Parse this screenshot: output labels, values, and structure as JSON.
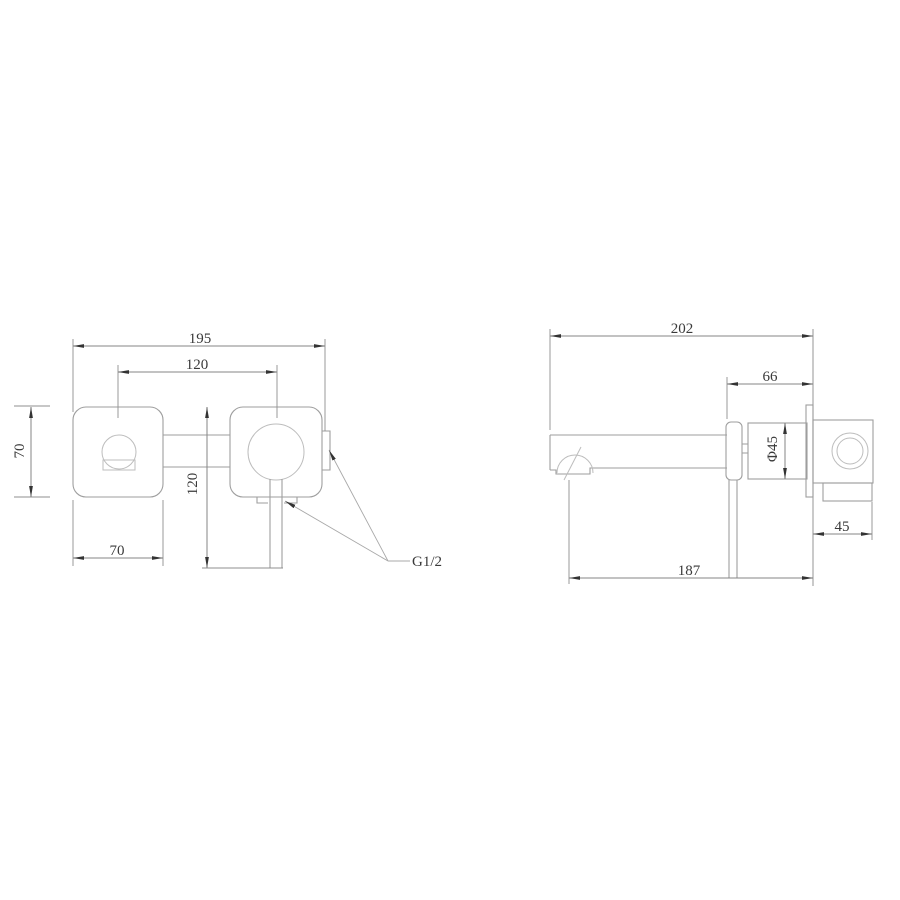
{
  "drawing_type": "faucet-installation-dimension-diagram",
  "colors": {
    "background": "#ffffff",
    "object_line": "#9e9e9e",
    "thin_line": "#bdbdbd",
    "dimension_line": "#858585",
    "leader_line": "#a8a8a8",
    "text": "#3a3a3a",
    "arrowhead": "#333333"
  },
  "front_view": {
    "overall_width": "195",
    "port_spacing": "120",
    "plate_height": "70",
    "plate_width": "70",
    "handle_length": "120",
    "thread_label": "G1/2"
  },
  "side_view": {
    "overall_projection": "202",
    "handle_offset": "66",
    "body_diameter": "Φ45",
    "inwall_depth": "45",
    "spout_reach": "187"
  }
}
